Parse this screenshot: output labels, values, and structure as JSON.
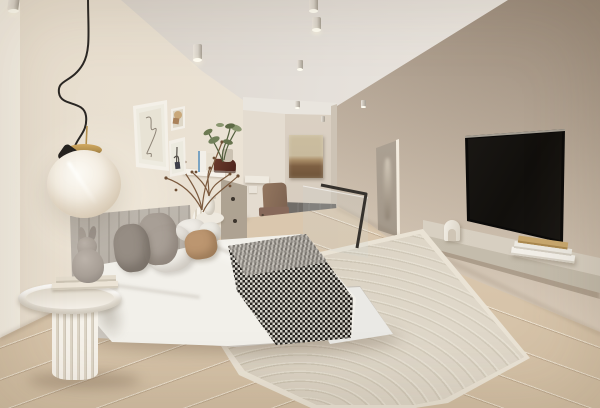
{
  "meta": {
    "scene": "minimalist bedroom interior render",
    "style": "neutral beige palette, soft daylight",
    "text_content": "none"
  },
  "objects": [
    "pendant-globe-lamp",
    "gallery-wall-frames",
    "bed",
    "channel-tufted-headboard",
    "pillows",
    "checkered-throw-runner",
    "white-duvet",
    "round-fluted-side-table",
    "stacked-books",
    "bunny-figurine",
    "dresser",
    "dried-branch-vase",
    "potted-plant",
    "bedside-vase",
    "hallway",
    "accent-chair",
    "wall-desk",
    "abstract-painting",
    "stair-glass-railing",
    "black-handrail",
    "arc-pattern-area-rug",
    "oak-wood-floor",
    "wall-mounted-tv",
    "floating-media-shelf",
    "shelf-books",
    "arch-bookend",
    "portrait-artwork",
    "ceiling-spotlights"
  ],
  "palette": {
    "ceiling_l": "#d6cfc6",
    "ceiling_r": "#efeae3",
    "wall_left_a": "#e7ddcd",
    "wall_left_b": "#ece4d7",
    "wall_hall": "#e4dcd0",
    "wall_far": "#d9cfc2",
    "wall_soffit": "#e9e5de",
    "alcove_edge": "#cdc3b5",
    "wall_right_top": "#b2a393",
    "wall_right_mid": "#cfc1b0",
    "wall_right_low": "#e9dccb",
    "floor_a": "#c9b69c",
    "floor_b": "#dccab2",
    "floor_c": "#d2bfa4",
    "landing": "#716d68",
    "glow": "#ffe9c2",
    "rug_base": "#d6cdbd",
    "rug_dark": "#c6bdab",
    "rug_light": "#e0d9ca",
    "rug_bind": "#eae3d5",
    "duvet": "#f2f0ea",
    "bed_base": "#d2cdc6",
    "bed_base_light": "#eae9e5",
    "headboard_a": "#c2bbb2",
    "headboard_b": "#aea79e",
    "pil_a": "#968d84",
    "pil_b": "#a89f96",
    "pil_white": "#eae7e1",
    "pil_tan": "#bc9670",
    "pil_small": "#efece6",
    "runner_k": "#171410",
    "runner_w": "#f0ede5",
    "table": "#f0ebe2",
    "flute_a": "#f6f2ea",
    "flute_b": "#ddd5c6",
    "bunny": "#a89f96",
    "globe_a": "#fcfaf4",
    "globe_b": "#e9dfcf",
    "globe_c": "#d2c4ad",
    "brass": "#b5914f",
    "cord": "#2a2724",
    "tv_frame": "#0b0a09",
    "tv_a": "#16130f",
    "tv_b": "#2c2824",
    "shelf_top": "#d6cec0",
    "shelf_front": "#c2baaa",
    "book_tan": "#c8a76d",
    "paper": "#f2efe8",
    "chair_a": "#93765f",
    "chair_b": "#7c6250",
    "chair_leg": "#544639",
    "art_top": "#c8ba9d",
    "art_band": "#7e6043",
    "fig_wall": "#ada293",
    "glass": "rgba(205,212,208,0.20)",
    "rail": "#36322d",
    "spot": "#d8d2c8",
    "spot_dark": "#a59e92",
    "lens": "#fffdf2",
    "green_a": "#6d7a52",
    "green_b": "#8a9770",
    "branch": "#7b5a3e",
    "white_obj": "#f2eee5"
  }
}
